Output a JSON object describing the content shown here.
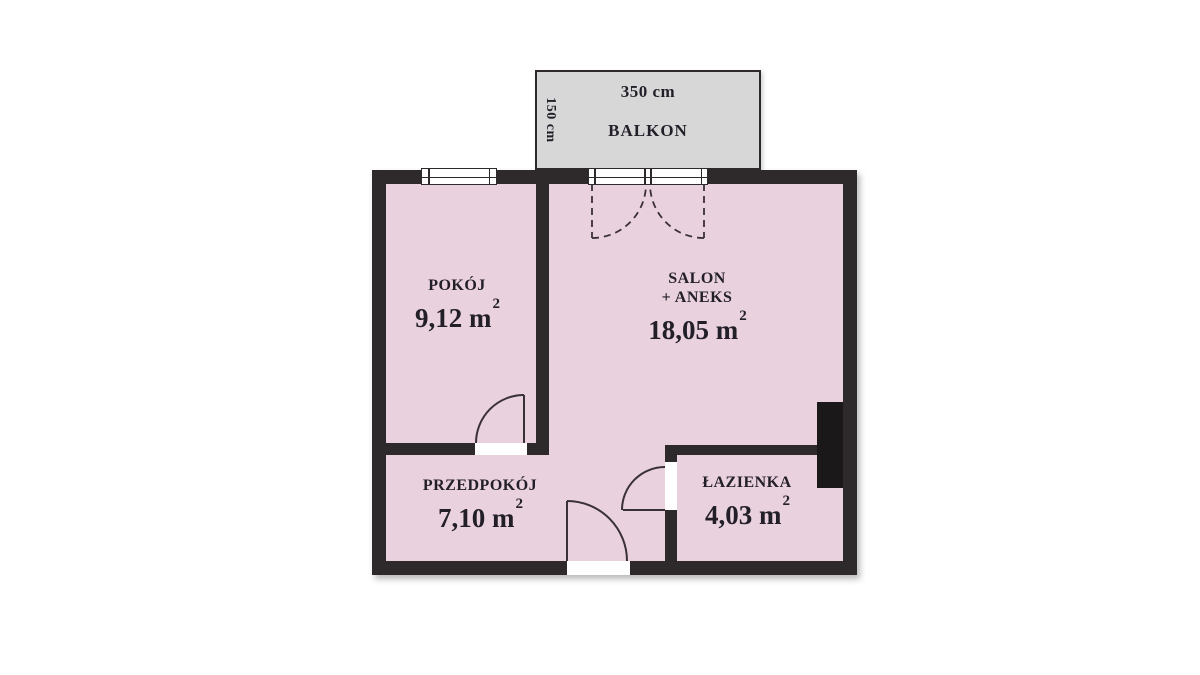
{
  "colors": {
    "room_fill": "#e9d1de",
    "balcony_fill": "#d8d7d7",
    "wall": "#2e2a2b",
    "shaft": "#1a1818",
    "line": "#3a3138",
    "text": "#231f29",
    "background": "#ffffff"
  },
  "balcony": {
    "label": "BALKON",
    "dim_width": "350 cm",
    "dim_depth": "150 cm"
  },
  "rooms": {
    "pokoj": {
      "name": "POKÓJ",
      "area": "9,12",
      "unit": "m",
      "sup": "2"
    },
    "salon": {
      "name": "SALON",
      "name2": "+ ANEKS",
      "area": "18,05",
      "unit": "m",
      "sup": "2"
    },
    "przedpokoj": {
      "name": "PRZEDPOKÓJ",
      "area": "7,10",
      "unit": "m",
      "sup": "2"
    },
    "lazienka": {
      "name": "ŁAZIENKA",
      "area": "4,03",
      "unit": "m",
      "sup": "2"
    }
  }
}
